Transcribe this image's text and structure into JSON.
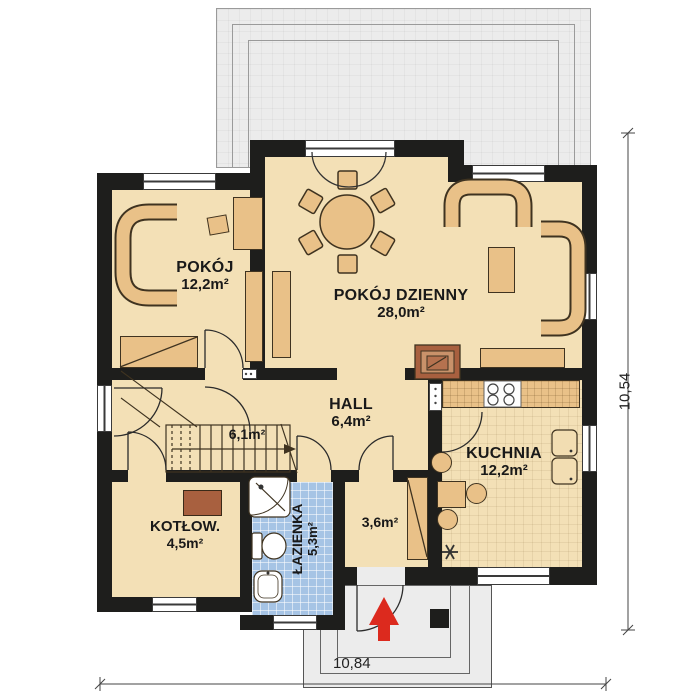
{
  "plan_title": "floor-plan",
  "rooms": {
    "pokoj": {
      "name": "POKÓJ",
      "area": "12,2m²"
    },
    "living": {
      "name": "POKÓJ DZIENNY",
      "area": "28,0m²"
    },
    "hall": {
      "name": "HALL",
      "area": "6,4m²"
    },
    "stairs": {
      "area": "6,1m²"
    },
    "kitchen": {
      "name": "KUCHNIA",
      "area": "12,2m²"
    },
    "boiler": {
      "name": "KOTŁOW.",
      "area": "4,5m²"
    },
    "bathroom": {
      "name": "ŁAZIENKA",
      "area": "5,3m²"
    },
    "vestibule": {
      "area": "3,6m²"
    }
  },
  "dimensions": {
    "width": "10,84",
    "height": "10,54"
  },
  "colors": {
    "wall": "#1e1e1c",
    "floor": "#f3e0b6",
    "furniture": "#e9c188",
    "furniture_outline": "#3f3320",
    "bathroom_floor": "#a6c4e5",
    "terrace": "#ececec",
    "fireplace": "#a8603f",
    "entrance_arrow": "#dc2a1e"
  }
}
